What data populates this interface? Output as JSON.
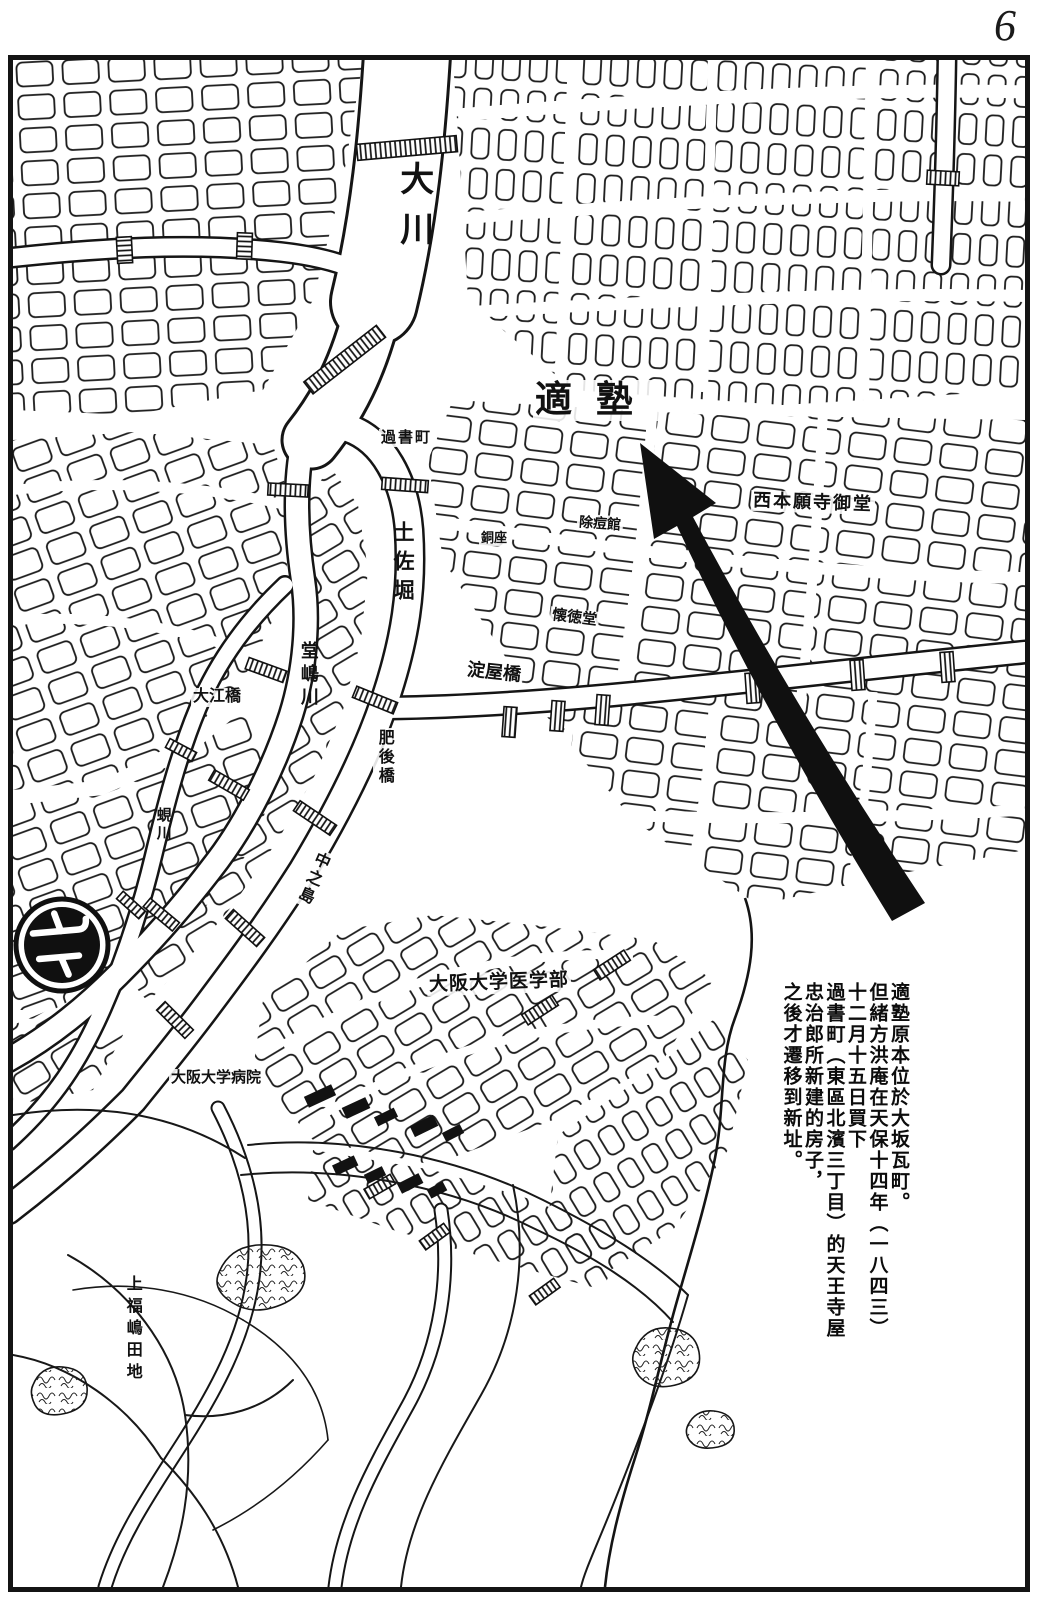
{
  "page": {
    "number": "6"
  },
  "map": {
    "compass": {
      "glyph": "北"
    },
    "labels": {
      "okawa": "大川",
      "kakashomachi": "過書町",
      "tosabori": "土佐堀",
      "dojimagawa": "堂嶋川",
      "shijimigawa": "蜆川",
      "nakanoshima": "中之島",
      "oebashi": "大江橋",
      "yodoyabashi": "淀屋橋",
      "higobashi": "肥後橋",
      "tekijuku": "適塾",
      "nishi_honganji_midou": "西本願寺御堂",
      "kaitokudo": "懐徳堂",
      "doza": "銅座",
      "jotokan": "除痘館",
      "osaka_univ_med_school": "大阪大学医学部",
      "osaka_univ_hospital": "大阪大学病院",
      "kamifukushima_denchi": "上福嶋田地"
    },
    "caption": {
      "lines": [
        "適塾原本位於大坂瓦町。",
        "但緒方洪庵在天保十四年（一八四三）",
        "十二月十五日買下",
        "過書町（東區北濱三丁目）的天王寺屋",
        "忠治郎所新建的房子，",
        "之後才遷移到新址。"
      ]
    }
  }
}
